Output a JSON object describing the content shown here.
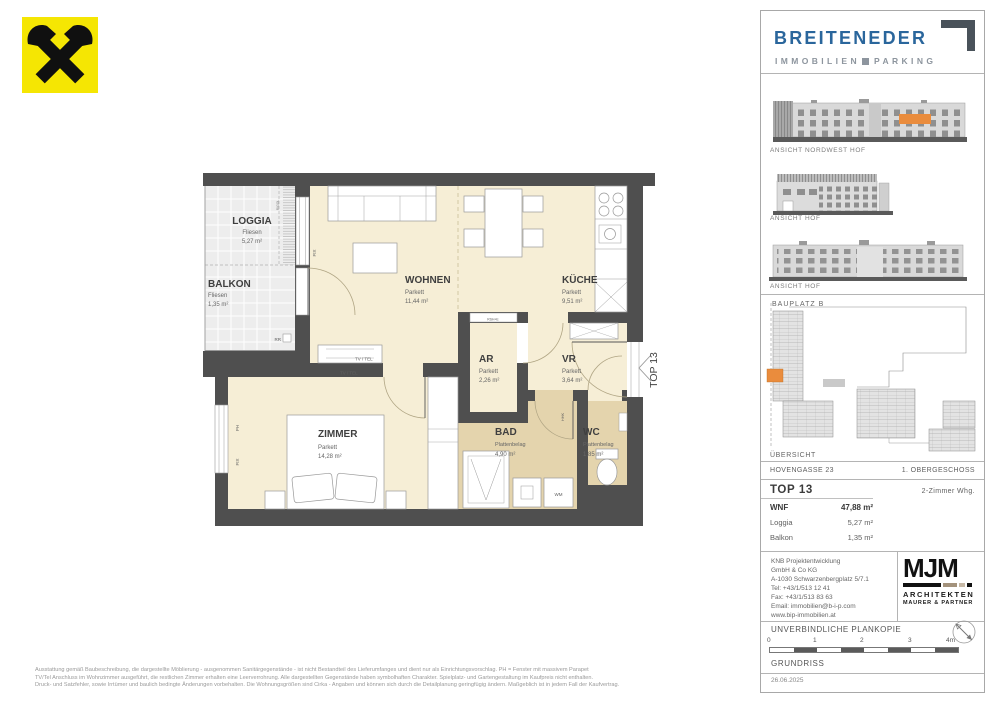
{
  "logos": {
    "raiffeisen": "raiffeisen-gable-cross",
    "brand": "BREITENEDER",
    "brand_sub_left": "IMMOBILIEN",
    "brand_sub_right": "PARKING"
  },
  "plan": {
    "rooms": [
      {
        "name": "LOGGIA",
        "floor": "Fliesen",
        "area": "5,27 m²"
      },
      {
        "name": "BALKON",
        "floor": "Fliesen",
        "area": "1,35 m²"
      },
      {
        "name": "WOHNEN",
        "floor": "Parkett",
        "area": "11,44 m²"
      },
      {
        "name": "KÜCHE",
        "floor": "Parkett",
        "area": "9,51 m²"
      },
      {
        "name": "AR",
        "floor": "Parkett",
        "area": "2,26 m²"
      },
      {
        "name": "VR",
        "floor": "Parkett",
        "area": "3,64 m²"
      },
      {
        "name": "BAD",
        "floor": "Plattenbelag",
        "area": "4,90 m²"
      },
      {
        "name": "WC",
        "floor": "Plattenbelag",
        "area": "1,85 m²"
      },
      {
        "name": "ZIMMER",
        "floor": "Parkett",
        "area": "14,28 m²"
      }
    ],
    "annotations": {
      "fix": "FIX",
      "ph": "PH",
      "rr": "RR",
      "rigol": "RIGOL",
      "rshe": "RSH+E",
      "hhk": "HHK",
      "wm": "WM",
      "tvtel": "TV / TEL",
      "top": "TOP 13"
    }
  },
  "sidebar": {
    "elevations": [
      {
        "caption": "ANSICHT NORDWEST HOF"
      },
      {
        "caption": "ANSICHT HOF"
      },
      {
        "caption": "ANSICHT HOF"
      }
    ],
    "siteplan": {
      "label": "BAUPLATZ  B",
      "caption": "ÜBERSICHT"
    },
    "info": {
      "street": "HOVENGASSE 23",
      "level": "1. OBERGESCHOSS",
      "unit": "TOP 13",
      "type": "2-Zimmer Whg.",
      "rows": [
        {
          "label": "WNF",
          "value": "47,88 m²"
        },
        {
          "label": "Loggia",
          "value": "5,27 m²"
        },
        {
          "label": "Balkon",
          "value": "1,35 m²"
        }
      ]
    },
    "contact": {
      "lines": [
        "KNB Projektentwicklung",
        "GmbH & Co KG",
        "A-1030 Schwarzenbergplatz 5/7.1",
        "Tel: +43/1/513 12 41",
        "Fax: +43/1/513 83 63",
        "Email: immobilien@b-i-p.com",
        "www.bip-immobilien.at"
      ]
    },
    "architects": {
      "logo": "MJM",
      "line1": "ARCHITEKTEN",
      "line2": "MAURER & PARTNER"
    },
    "footer": {
      "plankopie": "UNVERBINDLICHE PLANKOPIE",
      "scale_labels": [
        "0",
        "1",
        "2",
        "3",
        "4m"
      ],
      "caption": "GRUNDRISS",
      "date": "26.06.2025"
    }
  },
  "disclaimer": {
    "lines": [
      "Ausstattung gemäß Baubeschreibung, die dargestellte Möblierung - ausgenommen Sanitärgegenstände - ist nicht Bestandteil des Lieferumfanges und dient nur als Einrichtungsvorschlag. PH = Fenster mit massivem Parapet",
      "TV/Tel Anschluss im Wohnzimmer ausgeführt, die restlichen Zimmer erhalten eine Leerverrohrung. Alle dargestellten Gegenstände haben symbolhaften Charakter. Spielplatz- und Gartengestaltung im Kaufpreis nicht enthalten.",
      "Druck- und Satzfehler, sowie Irrtümer und baulich bedingte Änderungen vorbehalten. Die Wohnungsgrößen sind Cirka - Angaben und können sich durch die Detailplanung geringfügig ändern. Maßgeblich ist in jedem Fall der Kaufvertrag."
    ]
  },
  "colors": {
    "accent_orange": "#ea8c3d",
    "brand_blue": "#2a669c",
    "wall_gray": "#4f4f4f",
    "parkett_cream": "#f6eed6",
    "platten_tan": "#e4d4ad",
    "raiffeisen_yellow": "#f5e603"
  }
}
